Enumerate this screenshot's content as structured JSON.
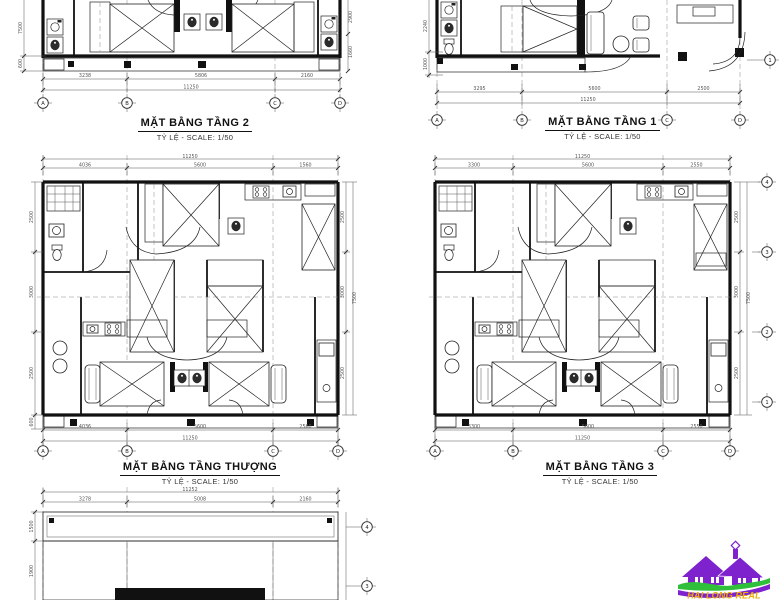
{
  "sheet": {
    "background": "#ffffff",
    "line_color": "#111111"
  },
  "plans": {
    "t2": {
      "title": "MẶT BẰNG TẦNG 2",
      "scale": "TỶ LỆ - SCALE: 1/50",
      "dims": [
        "3238",
        "5806",
        "2160"
      ],
      "total": "11250",
      "dims_left": [
        "7500",
        "600"
      ],
      "dims_right": [
        "2900",
        "1660"
      ],
      "cols": [
        "A",
        "B",
        "C",
        "D"
      ]
    },
    "t1": {
      "title": "MẶT BẰNG TẦNG 1",
      "scale": "TỶ LỆ - SCALE: 1/50",
      "dims": [
        "3295",
        "5600",
        "2500"
      ],
      "total": "11250",
      "dims_left": [
        "2240",
        "1000"
      ],
      "row_right": "1",
      "cols": [
        "A",
        "B",
        "C",
        "D"
      ]
    },
    "thuong": {
      "title": "MẶT BẰNG TẦNG THƯỢNG",
      "scale": "TỶ LỆ - SCALE: 1/50",
      "dims_top": [
        "4036",
        "5600",
        "1560"
      ],
      "total_top": "11250",
      "dims_bottom": [
        "4036",
        "5600",
        "2560"
      ],
      "total_bottom": "11250",
      "dims_left": [
        "2500",
        "3000",
        "2500"
      ],
      "dim_left_small": "600",
      "dims_right": [
        "2500",
        "3000",
        "2500"
      ],
      "total_right": "7500",
      "cols": [
        "A",
        "B",
        "C",
        "D"
      ]
    },
    "t3": {
      "title": "MẶT BẰNG TẦNG 3",
      "scale": "TỶ LỆ - SCALE: 1/50",
      "dims_top": [
        "3300",
        "5600",
        "2550"
      ],
      "total_top": "11250",
      "dims_bottom": [
        "3300",
        "5600",
        "2550"
      ],
      "total_bottom": "11250",
      "dims_right": [
        "2500",
        "3000",
        "2500"
      ],
      "total_right": "7500",
      "rows": [
        "4",
        "3",
        "2",
        "1"
      ],
      "cols": [
        "A",
        "B",
        "C",
        "D"
      ]
    },
    "roof": {
      "dims_top": [
        "3278",
        "5008",
        "2160"
      ],
      "total_top": "11252",
      "dims_left": [
        "1500",
        "1900"
      ],
      "rows": [
        "4",
        "3"
      ]
    }
  },
  "logo": {
    "text": "HAI LONG REAL",
    "house_color": "#7e22ce",
    "wave_color": "#2fbf3a",
    "text_color": "#f0ad00"
  }
}
